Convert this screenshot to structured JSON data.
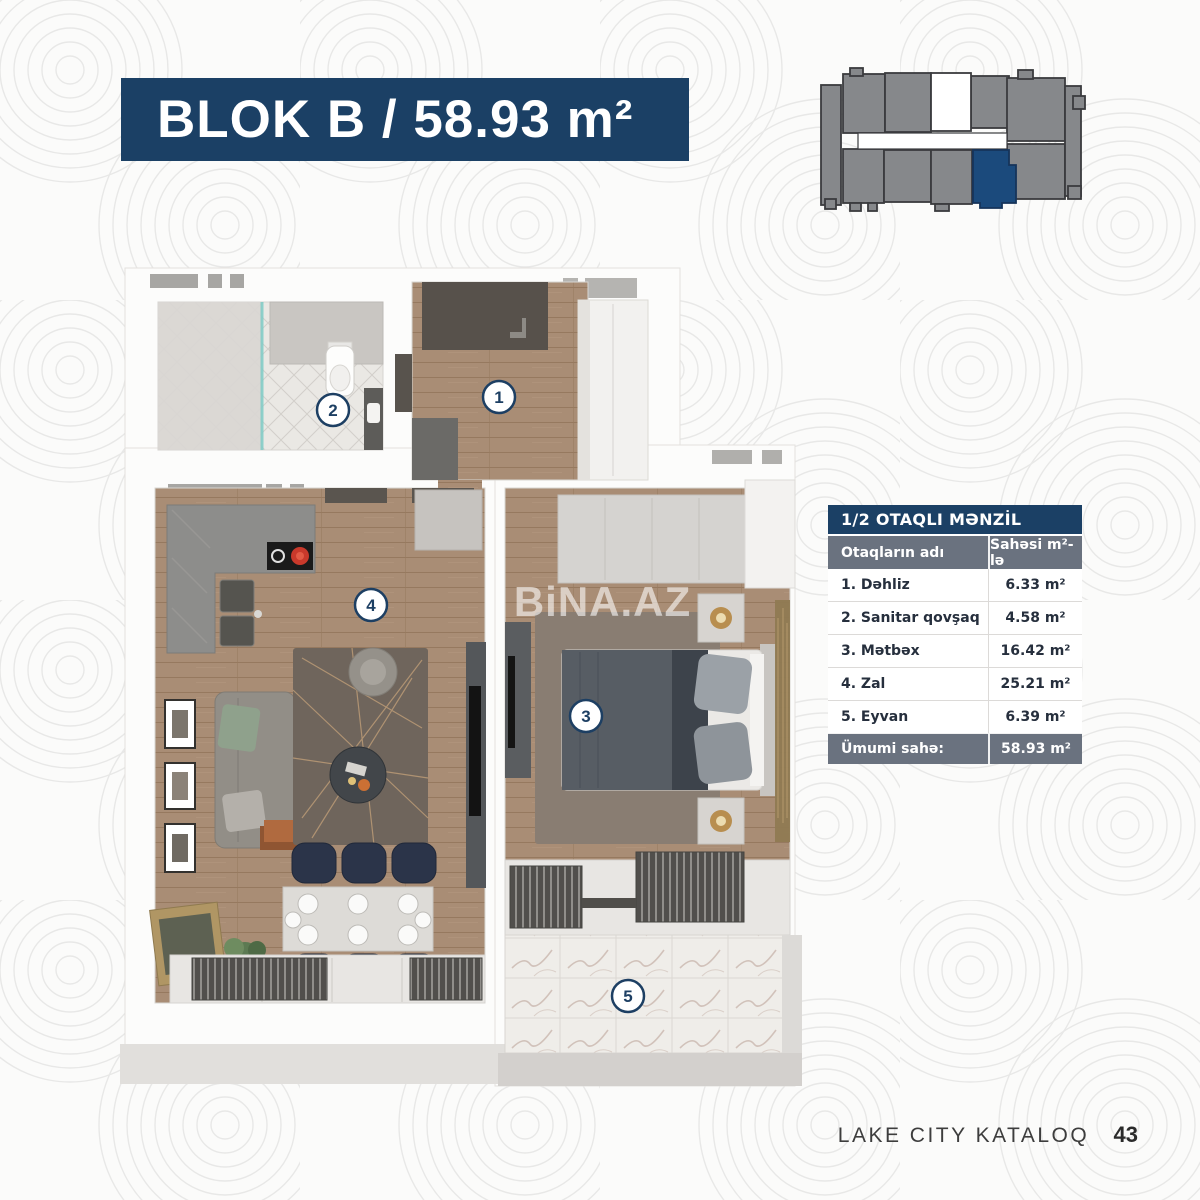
{
  "page": {
    "title": "BLOK B / 58.93 m²",
    "watermark": "BiNA.AZ",
    "footer": {
      "catalog_label": "LAKE CITY KATALOQ",
      "page_number": "43"
    }
  },
  "building_diagram": {
    "name": "building-floorplate-with-highlighted-unit",
    "highlight_color": "#1b4a7c",
    "unit_color": "#86888b"
  },
  "floor_plan": {
    "rooms": [
      {
        "number": "1"
      },
      {
        "number": "2"
      },
      {
        "number": "3"
      },
      {
        "number": "4"
      },
      {
        "number": "5"
      }
    ]
  },
  "table": {
    "title": "1/2 OTAQLI MƏNZİL",
    "columns": [
      "Otaqların adı",
      "Sahəsi m²-lə"
    ],
    "rows": [
      {
        "name": "1. Dəhliz",
        "area": "6.33 m²"
      },
      {
        "name": "2. Sanitar qovşaq",
        "area": "4.58 m²"
      },
      {
        "name": "3. Mətbəx",
        "area": "16.42 m²"
      },
      {
        "name": "4. Zal",
        "area": "25.21 m²"
      },
      {
        "name": "5. Eyvan",
        "area": "6.39 m²"
      }
    ],
    "total": {
      "label": "Ümumi sahə:",
      "value": "58.93 m²"
    }
  },
  "colors": {
    "banner_blue": "#1b4065",
    "table_gray": "#6a727f",
    "highlight_blue": "#1b4a7c",
    "body_text": "#262f3d"
  }
}
